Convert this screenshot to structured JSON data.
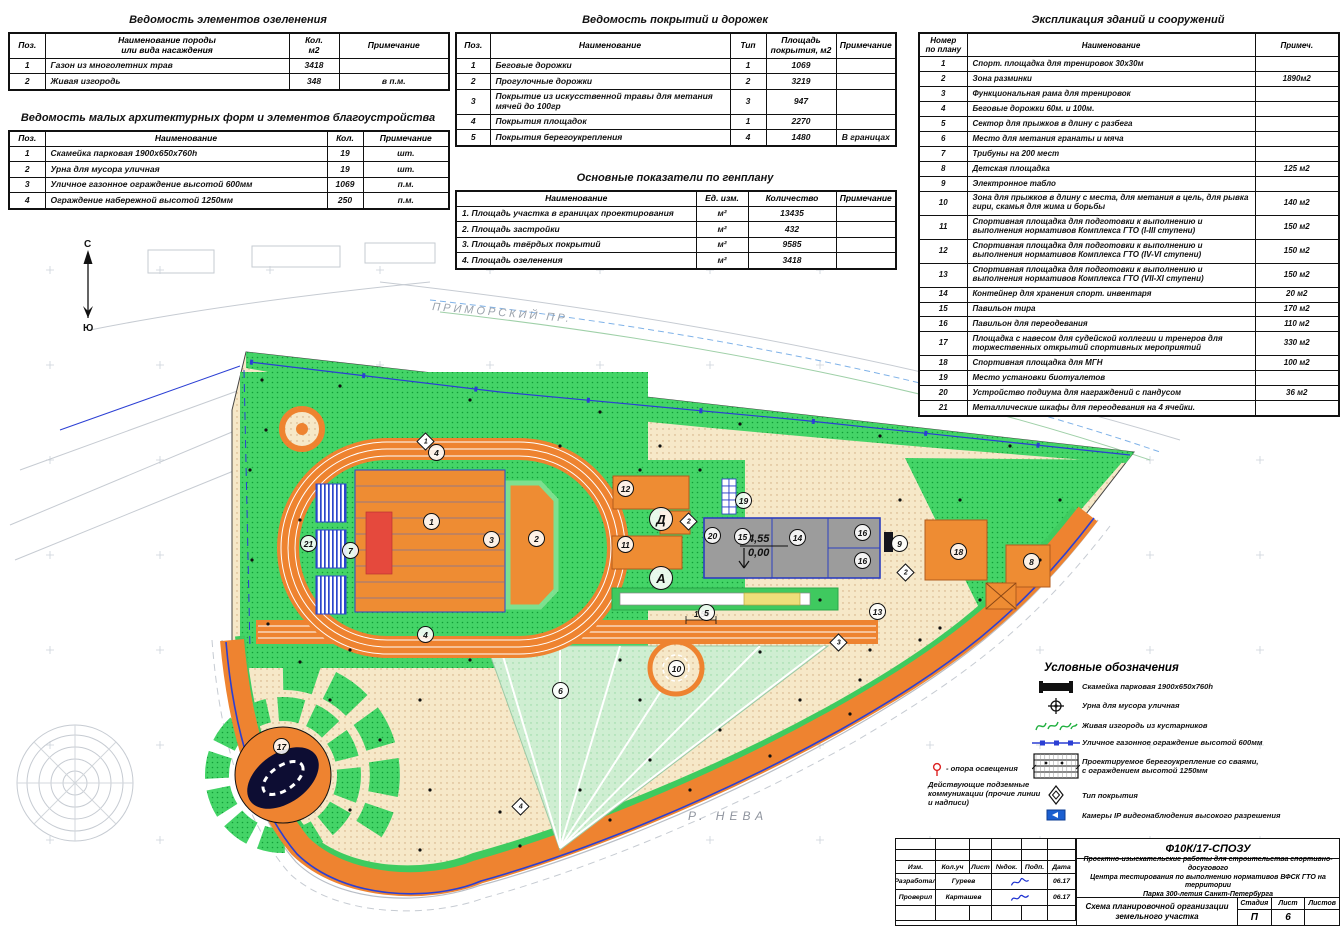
{
  "tables": {
    "greening": {
      "title": "Ведомость элементов озеленения",
      "headers": [
        "Поз.",
        "Наименование породы\nили вида насаждения",
        "Кол.\nм2",
        "Примечание"
      ],
      "rows": [
        [
          "1",
          "Газон из многолетних трав",
          "3418",
          ""
        ],
        [
          "2",
          "Живая изгородь",
          "348",
          "в п.м."
        ]
      ]
    },
    "maf": {
      "title": "Ведомость малых архитектурных форм и элементов благоустройства",
      "headers": [
        "Поз.",
        "Наименование",
        "Кол.",
        "Примечание"
      ],
      "rows": [
        [
          "1",
          "Скамейка парковая 1900х650х760h",
          "19",
          "шт."
        ],
        [
          "2",
          "Урна для мусора уличная",
          "19",
          "шт."
        ],
        [
          "3",
          "Уличное газонное ограждение высотой 600мм",
          "1069",
          "п.м."
        ],
        [
          "4",
          "Ограждение набережной высотой 1250мм",
          "250",
          "п.м."
        ]
      ]
    },
    "surfaces": {
      "title": "Ведомость покрытий и дорожек",
      "headers": [
        "Поз.",
        "Наименование",
        "Тип",
        "Площадь\nпокрытия, м2",
        "Примечание"
      ],
      "rows": [
        [
          "1",
          "Беговые дорожки",
          "1",
          "1069",
          ""
        ],
        [
          "2",
          "Прогулочные дорожки",
          "2",
          "3219",
          ""
        ],
        [
          "3",
          "Покрытие из искусственной травы для метания мячей до 100гр",
          "3",
          "947",
          ""
        ],
        [
          "4",
          "Покрытия площадок",
          "1",
          "2270",
          ""
        ],
        [
          "5",
          "Покрытия берегоукрепления",
          "4",
          "1480",
          "В границах"
        ]
      ]
    },
    "indicators": {
      "title": "Основные показатели по генплану",
      "headers": [
        "Наименование",
        "Ед. изм.",
        "Количество",
        "Примечание"
      ],
      "rows": [
        [
          "1. Площадь участка в границах проектирования",
          "м²",
          "13435",
          ""
        ],
        [
          "2. Площадь застройки",
          "м²",
          "432",
          ""
        ],
        [
          "3. Площадь твёрдых покрытий",
          "м²",
          "9585",
          ""
        ],
        [
          "4. Площадь озеленения",
          "м²",
          "3418",
          ""
        ]
      ]
    },
    "explication": {
      "title": "Экспликация зданий и сооружений",
      "headers": [
        "Номер\nпо плану",
        "Наименование",
        "Примеч."
      ],
      "rows": [
        [
          "1",
          "Спорт. площадка для тренировок 30х30м",
          ""
        ],
        [
          "2",
          "Зона разминки",
          "1890м2"
        ],
        [
          "3",
          "Функциональная рама для тренировок",
          ""
        ],
        [
          "4",
          "Беговые дорожки 60м. и 100м.",
          ""
        ],
        [
          "5",
          "Сектор для прыжков в длину с разбега",
          ""
        ],
        [
          "6",
          "Место для метания гранаты и мяча",
          ""
        ],
        [
          "7",
          "Трибуны на 200 мест",
          ""
        ],
        [
          "8",
          "Детская площадка",
          "125 м2"
        ],
        [
          "9",
          "Электронное табло",
          ""
        ],
        [
          "10",
          "Зона для прыжков в длину с места, для метания в цель, для рывка гири, скамья для жима и борьбы",
          "140 м2"
        ],
        [
          "11",
          "Спортивная площадка для подготовки к выполнению и выполнения нормативов Комплекса ГТО (I-III ступени)",
          "150 м2"
        ],
        [
          "12",
          "Спортивная площадка для подготовки к выполнению и выполнения нормативов Комплекса ГТО (IV-VI ступени)",
          "150 м2"
        ],
        [
          "13",
          "Спортивная площадка для подготовки к выполнению и выполнения нормативов Комплекса ГТО (VII-XI ступени)",
          "150 м2"
        ],
        [
          "14",
          "Контейнер для хранения спорт. инвентаря",
          "20 м2"
        ],
        [
          "15",
          "Павильон тира",
          "170 м2"
        ],
        [
          "16",
          "Павильон для переодевания",
          "110 м2"
        ],
        [
          "17",
          "Площадка с навесом для судейской коллегии и тренеров для торжественных открытий спортивных мероприятий",
          "330 м2"
        ],
        [
          "18",
          "Спортивная площадка для МГН",
          "100 м2"
        ],
        [
          "19",
          "Место установки биотуалетов",
          ""
        ],
        [
          "20",
          "Устройство подиума для награждений с пандусом",
          "36 м2"
        ],
        [
          "21",
          "Металлические шкафы для переодевания на 4 ячейки.",
          ""
        ]
      ]
    }
  },
  "legend": {
    "title": "Условные обозначения",
    "items": [
      {
        "icon": "bench-icon",
        "label": "Скамейка парковая 1900х650х760h"
      },
      {
        "icon": "urn-icon",
        "label": "Урна для мусора уличная"
      },
      {
        "icon": "hedge-icon",
        "label": "Живая изгородь из кустарников"
      },
      {
        "icon": "fence-icon",
        "label": "Уличное газонное ограждение высотой 600мм"
      },
      {
        "icon": "embankment-icon",
        "label": "Проектируемое берегоукрепление со сваями,\nс ограждением высотой 1250мм"
      },
      {
        "icon": "surface-type-icon",
        "label": "Тип покрытия"
      },
      {
        "icon": "camera-icon",
        "label": "Камеры IP видеонаблюдения высокого разрешения"
      }
    ],
    "left_items": [
      {
        "icon": "light-pole-icon",
        "label": "- опора освещения"
      },
      {
        "icon": "none",
        "label": "Действующие подземные\nкоммуникации (прочие линии\nи надписи)"
      }
    ]
  },
  "plan": {
    "compass": {
      "north": "С",
      "south": "Ю"
    },
    "street_label": "ПРИМОРСКИЙ ПР.",
    "river_label": "Р. НЕВА",
    "elevation_top": "4,55",
    "elevation_bottom": "0,00",
    "dimension": "1,50",
    "markers": [
      {
        "n": "1",
        "x": 431,
        "y": 521
      },
      {
        "n": "2",
        "x": 536,
        "y": 538
      },
      {
        "n": "3",
        "x": 491,
        "y": 539
      },
      {
        "n": "4",
        "x": 436,
        "y": 452
      },
      {
        "n": "4",
        "x": 425,
        "y": 634
      },
      {
        "n": "5",
        "x": 706,
        "y": 612
      },
      {
        "n": "6",
        "x": 560,
        "y": 690
      },
      {
        "n": "7",
        "x": 350,
        "y": 550
      },
      {
        "n": "8",
        "x": 1031,
        "y": 561
      },
      {
        "n": "9",
        "x": 899,
        "y": 543
      },
      {
        "n": "10",
        "x": 676,
        "y": 668
      },
      {
        "n": "11",
        "x": 625,
        "y": 544
      },
      {
        "n": "12",
        "x": 625,
        "y": 488
      },
      {
        "n": "13",
        "x": 877,
        "y": 611
      },
      {
        "n": "14",
        "x": 797,
        "y": 537
      },
      {
        "n": "15",
        "x": 742,
        "y": 536
      },
      {
        "n": "16",
        "x": 862,
        "y": 532
      },
      {
        "n": "16",
        "x": 862,
        "y": 560
      },
      {
        "n": "17",
        "x": 281,
        "y": 746
      },
      {
        "n": "18",
        "x": 958,
        "y": 551
      },
      {
        "n": "19",
        "x": 743,
        "y": 500
      },
      {
        "n": "20",
        "x": 712,
        "y": 535
      },
      {
        "n": "21",
        "x": 308,
        "y": 543
      }
    ],
    "letter_markers": [
      {
        "n": "Д",
        "x": 661,
        "y": 519
      },
      {
        "n": "А",
        "x": 661,
        "y": 578
      }
    ],
    "type_markers": [
      {
        "n": "1",
        "x": 425,
        "y": 441
      },
      {
        "n": "2",
        "x": 688,
        "y": 521
      },
      {
        "n": "2",
        "x": 905,
        "y": 572
      },
      {
        "n": "3",
        "x": 838,
        "y": 642
      },
      {
        "n": "4",
        "x": 520,
        "y": 806
      }
    ]
  },
  "titleblock": {
    "code": "Ф10К/17-СПОЗУ",
    "project": "Проектно-изыскательские работы для строительства спортивно-досугового\nЦентра тестирования по выполнению нормативов ВФСК ГТО на территории\nПарка 300-летия Санкт-Петербурга",
    "sheet_title": "Схема планировочной организации\nземельного участка",
    "cols": [
      "Изм.",
      "Кол.уч",
      "Лист",
      "№док.",
      "Подп.",
      "Дата"
    ],
    "sig_rows": [
      {
        "role": "Разработал",
        "name": "Гуреев",
        "date": "06.17"
      },
      {
        "role": "Проверил",
        "name": "Карташев",
        "date": "06.17"
      }
    ],
    "stage_label": "Стадия",
    "sheet_label": "Лист",
    "sheets_label": "Листов",
    "stage": "П",
    "sheet": "6",
    "sheets": ""
  },
  "colors": {
    "orange": "#ee8330",
    "green": "#3ecb5f",
    "pale_green": "#cfeed2",
    "beige": "#f6e8c8",
    "blue": "#2238c8",
    "navy": "#0d0d33",
    "gray_building": "#9c9c9c",
    "red": "#e5493d"
  }
}
